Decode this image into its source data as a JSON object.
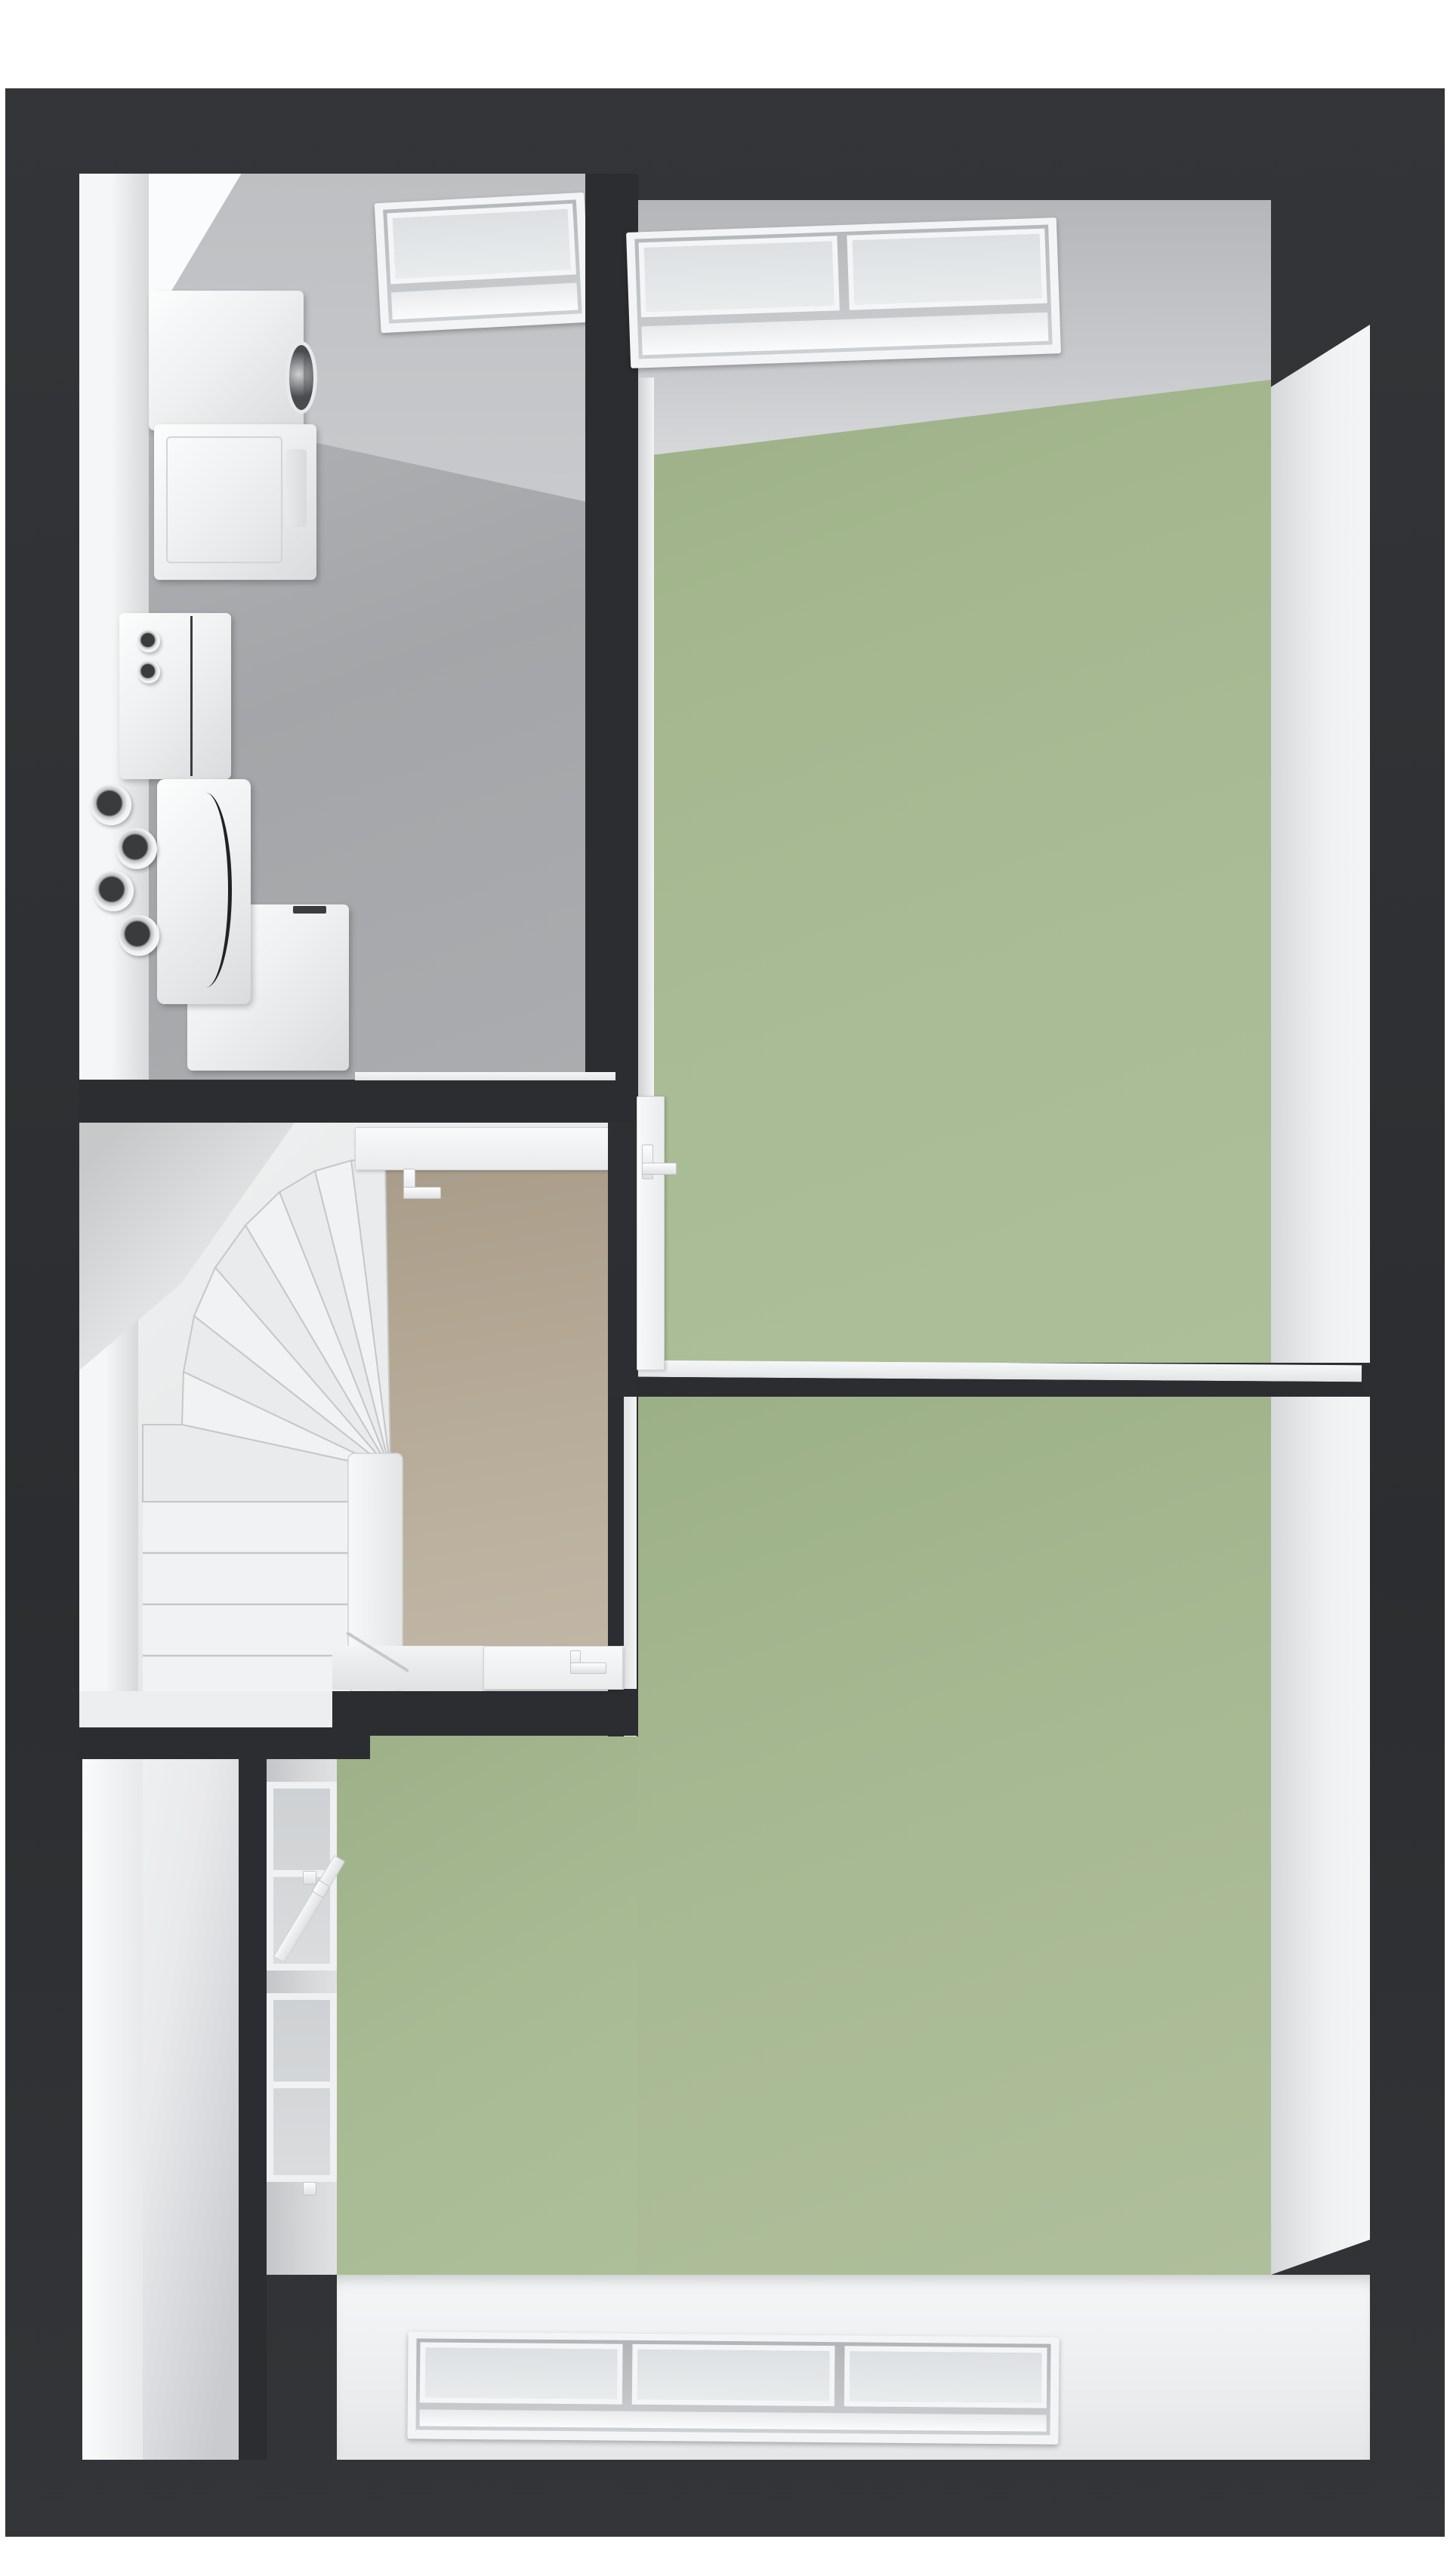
{
  "document": {
    "kind": "3d-floor-plan-top-down-render",
    "visible_text": "none"
  },
  "palette": {
    "page_bg": "#ffffff",
    "slab_dark_a": "#333538",
    "slab_dark_b": "#2b2d30",
    "green_floor": "#a9bb95",
    "green_floor_shadow": "#97aa82",
    "gray_floor": "#a6a8ab",
    "ceiling_gray": "#c9cbce",
    "white_wall": "#f3f4f6",
    "wall_shadow": "#d6d8da",
    "tan_floor": "#b3a794",
    "fixture_white": "#f0f1f3",
    "drum_dark": "#4a4b4e",
    "frame_line": "#c9cbcd"
  },
  "rooms": [
    {
      "id": "utility-room",
      "position": "top-left",
      "floor_color_key": "gray_floor",
      "appliances": [
        "dryer",
        "washer",
        "heat-pump-boiler",
        "ventilation-unit",
        "storage-tank"
      ],
      "duct_pipes": 4,
      "flue_pipes": 2,
      "roof_window_panes": 1
    },
    {
      "id": "stair-hall",
      "position": "middle-left",
      "floor_color_key": "tan_floor",
      "staircase": {
        "type": "winder",
        "fan_treads": 8,
        "straight_treads": 5
      },
      "doors": [
        "to-utility-room",
        "to-upper-bedroom",
        "to-lower-bedroom"
      ]
    },
    {
      "id": "upper-bedroom",
      "position": "top-right",
      "floor_color_key": "green_floor",
      "roof_window_panes": 2
    },
    {
      "id": "lower-bedroom",
      "position": "bottom-right",
      "shape": "L",
      "floor_color_key": "green_floor",
      "roof_window_panes": 3,
      "side_window": {
        "wall": "left",
        "sashes": 2,
        "open_sash": true
      }
    },
    {
      "id": "side-passage",
      "position": "bottom-left",
      "floor_color_key": "white_wall"
    }
  ],
  "doors": [
    {
      "from": "utility-room",
      "to": "stair-hall",
      "state": "open",
      "handle_visible": true
    },
    {
      "from": "stair-hall",
      "to": "upper-bedroom",
      "state": "open",
      "handle_visible": true
    },
    {
      "from": "stair-hall",
      "to": "lower-bedroom",
      "state": "open",
      "handle_visible": true
    }
  ],
  "roof_windows": [
    {
      "room": "utility-room",
      "panes": 1
    },
    {
      "room": "upper-bedroom",
      "panes": 2
    },
    {
      "room": "lower-bedroom",
      "panes": 3
    }
  ]
}
